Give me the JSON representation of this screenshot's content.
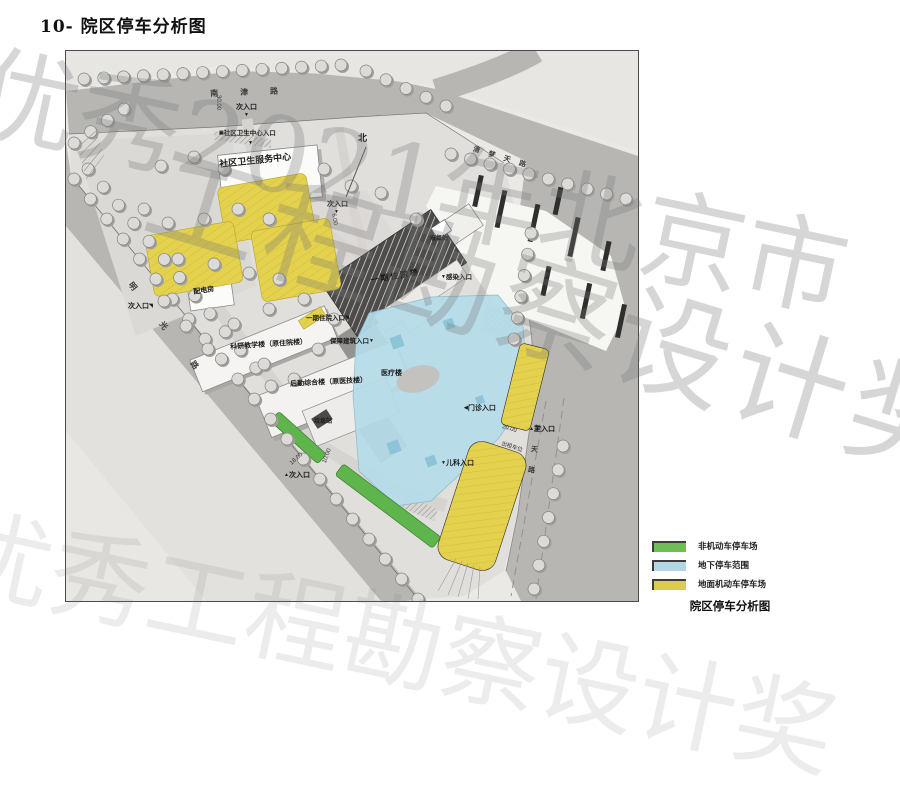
{
  "title": "10- 院区停车分析图",
  "watermark": {
    "line1": "优秀2021年北京市",
    "line2": "工程勘察设计奖",
    "line3": "优秀工程勘察设计奖"
  },
  "map": {
    "north_label": "北",
    "roads": {
      "top": "南津路",
      "northeast": "清梦天路",
      "left": "明光路",
      "right": "梦天路"
    },
    "buildings": {
      "community_health_center": "社区卫生服务中心",
      "power_distribution_room": "配电房",
      "research_teaching_building": "科研教学楼（原住院楼）",
      "logistics_complex_building": "后勤综合楼（原医技楼）",
      "phase1_inpatient_building": "一期住院楼",
      "medical_building": "医疗楼",
      "liquid_oxygen_station": "液氧站",
      "garbage_station": "垃圾站"
    },
    "entrances": {
      "north_secondary": "次入口",
      "community_center_entrance": "社区卫生中心入口",
      "center_secondary": "次入口",
      "infection_entrance": "感染入口",
      "phase1_inpatient_entrance": "一期住院入口",
      "support_building_entrance": "保障建筑入口",
      "outpatient_entrance": "门诊入口",
      "main_entrance": "主入口",
      "pediatrics_entrance": "儿科入口",
      "south_secondary": "次入口",
      "west_secondary": "次入口"
    },
    "annotations": {
      "taxi_spaces": "出租车位",
      "dim_30": "30.00",
      "dim_20": "20.00",
      "dim_18": "18.00",
      "dim_10": "10.00",
      "dim_6": "6.00"
    }
  },
  "legend": {
    "items": [
      {
        "label": "非机动车停车场",
        "color": "#6fbd55"
      },
      {
        "label": "地下停车范围",
        "color": "#b0d7e3"
      },
      {
        "label": "地面机动车停车场",
        "color": "#ddcc4a"
      }
    ],
    "caption": "院区停车分析图"
  }
}
